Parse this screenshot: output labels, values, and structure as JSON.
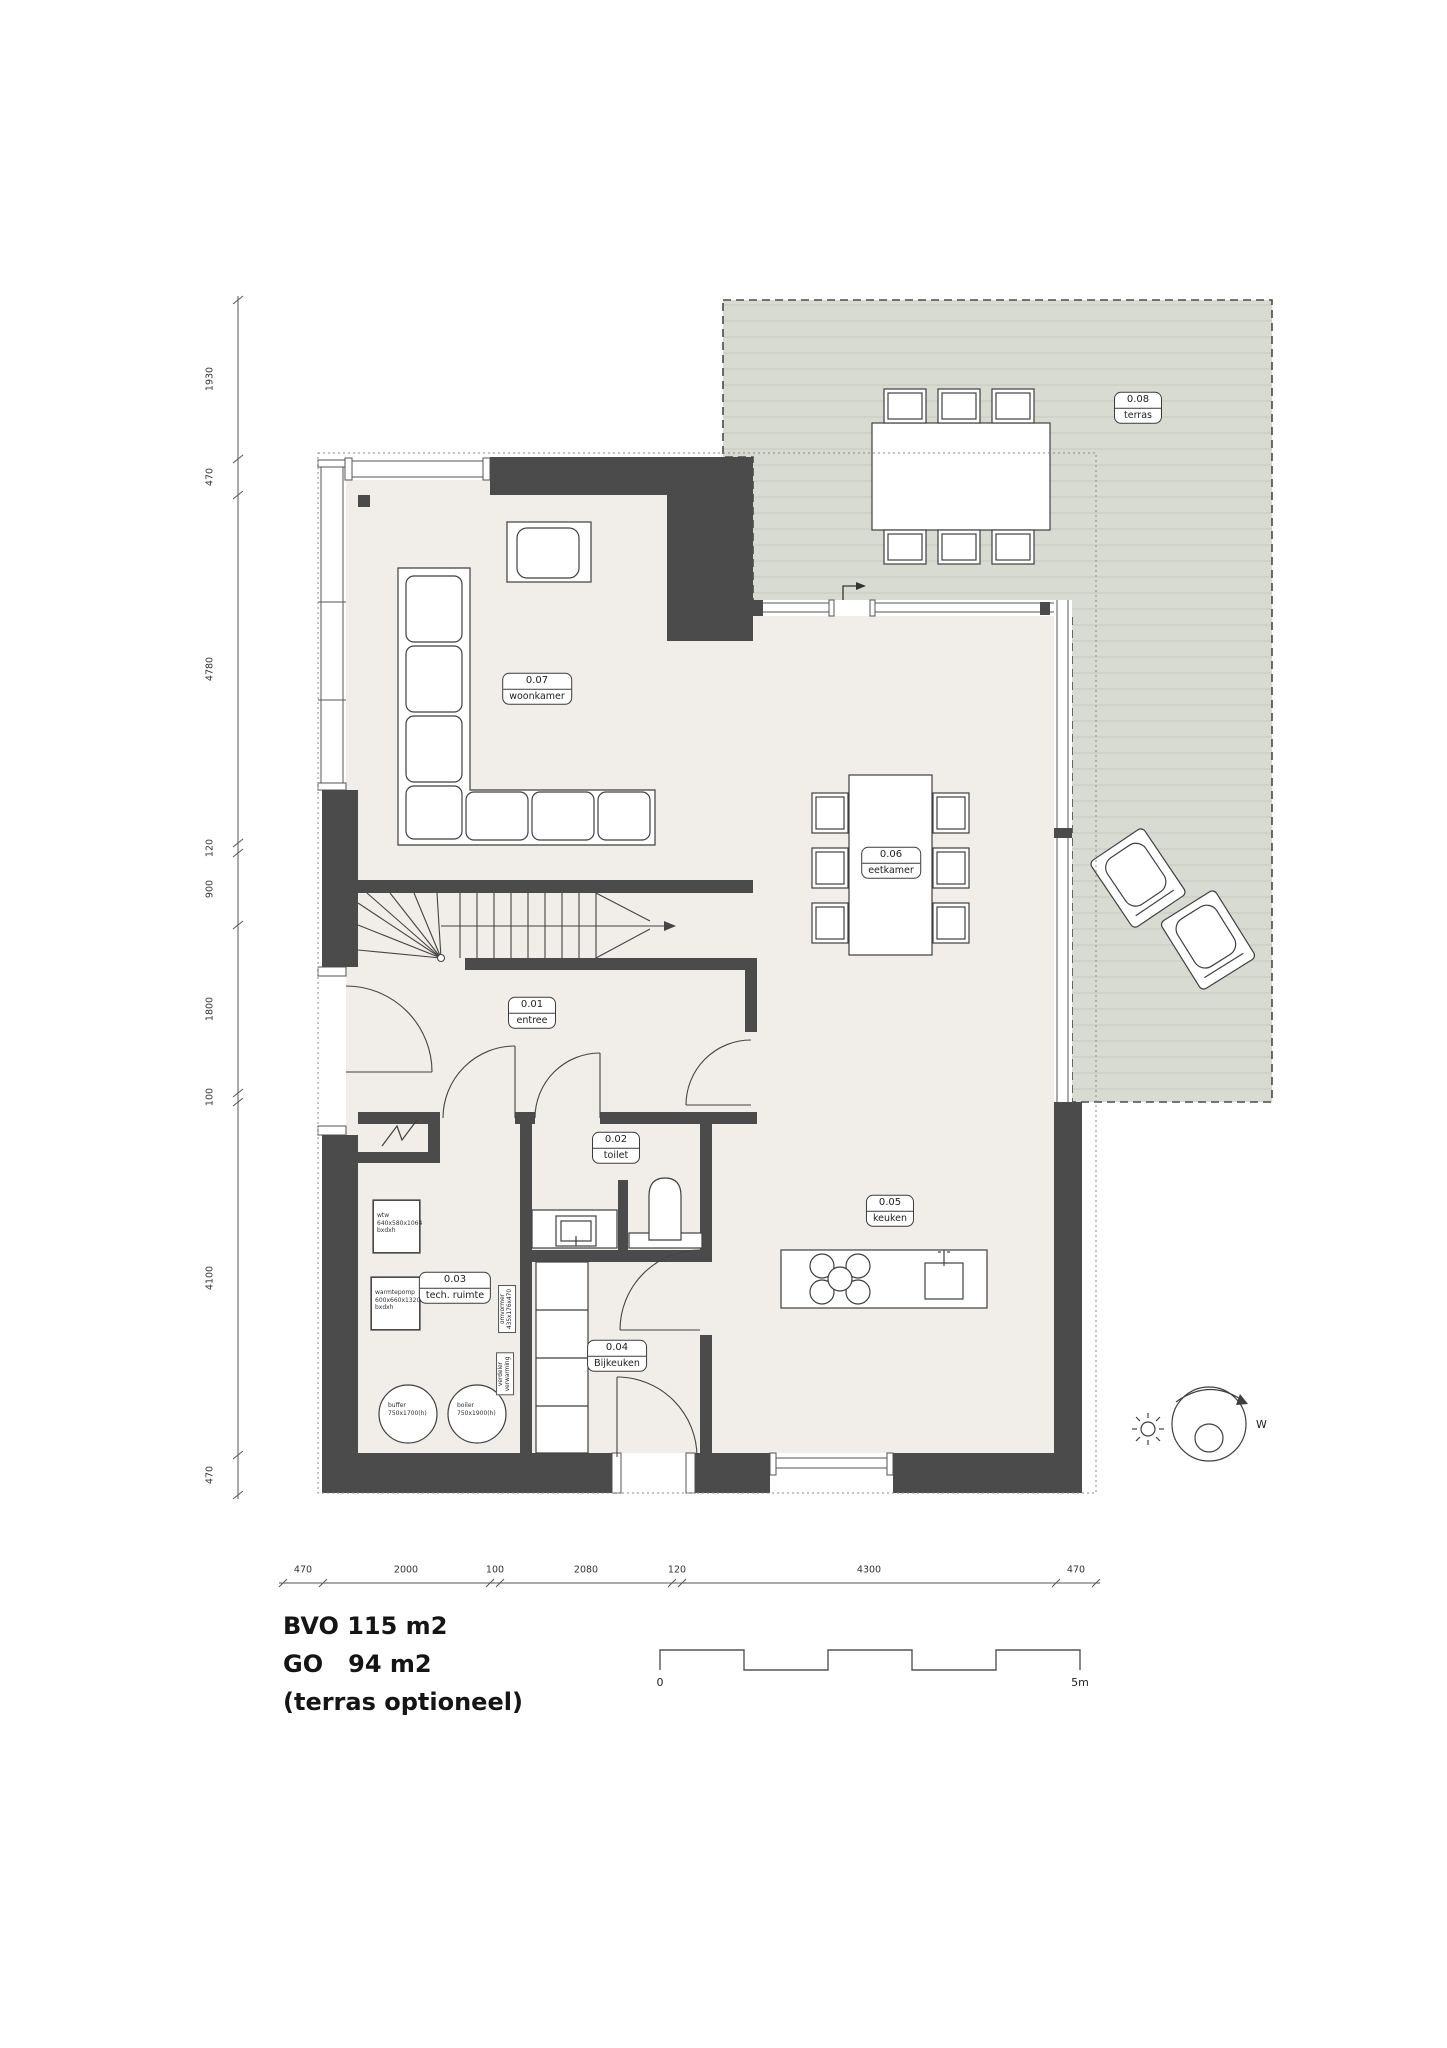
{
  "rooms": [
    {
      "id": "0.01",
      "name": "entree"
    },
    {
      "id": "0.02",
      "name": "toilet"
    },
    {
      "id": "0.03",
      "name": "tech. ruimte"
    },
    {
      "id": "0.04",
      "name": "Bijkeuken"
    },
    {
      "id": "0.05",
      "name": "keuken"
    },
    {
      "id": "0.06",
      "name": "eetkamer"
    },
    {
      "id": "0.07",
      "name": "woonkamer"
    },
    {
      "id": "0.08",
      "name": "terras"
    }
  ],
  "dims_left": [
    "1930",
    "470",
    "4780",
    "120",
    "900",
    "1800",
    "100",
    "4100",
    "470"
  ],
  "dims_bottom": [
    "470",
    "2000",
    "100",
    "2080",
    "120",
    "4300",
    "470"
  ],
  "equipment": {
    "wtw": "wtw\n640x580x1064\nbxdxh",
    "heatpump": "warmtepomp\n600x660x1320\nbxdxh",
    "buffer": "buffer\n750x1700(h)",
    "boiler": "boiler\n750x1900(h)",
    "inverter": "omvormer\n435x176x470",
    "manifold": "verdeler\nverwarming"
  },
  "title": {
    "bvo": "BVO 115 m2",
    "go": "GO   94 m2",
    "note": "(terras optioneel)"
  },
  "scalebar": {
    "start": "0",
    "end": "5m"
  },
  "compass": {
    "west": "W"
  },
  "colors": {
    "wall": "#4b4b4b",
    "floor": "#f1ede8",
    "terrace": "#d8dbd2",
    "terrace_hatch": "#c6cabf",
    "line": "#3f3f3f"
  }
}
